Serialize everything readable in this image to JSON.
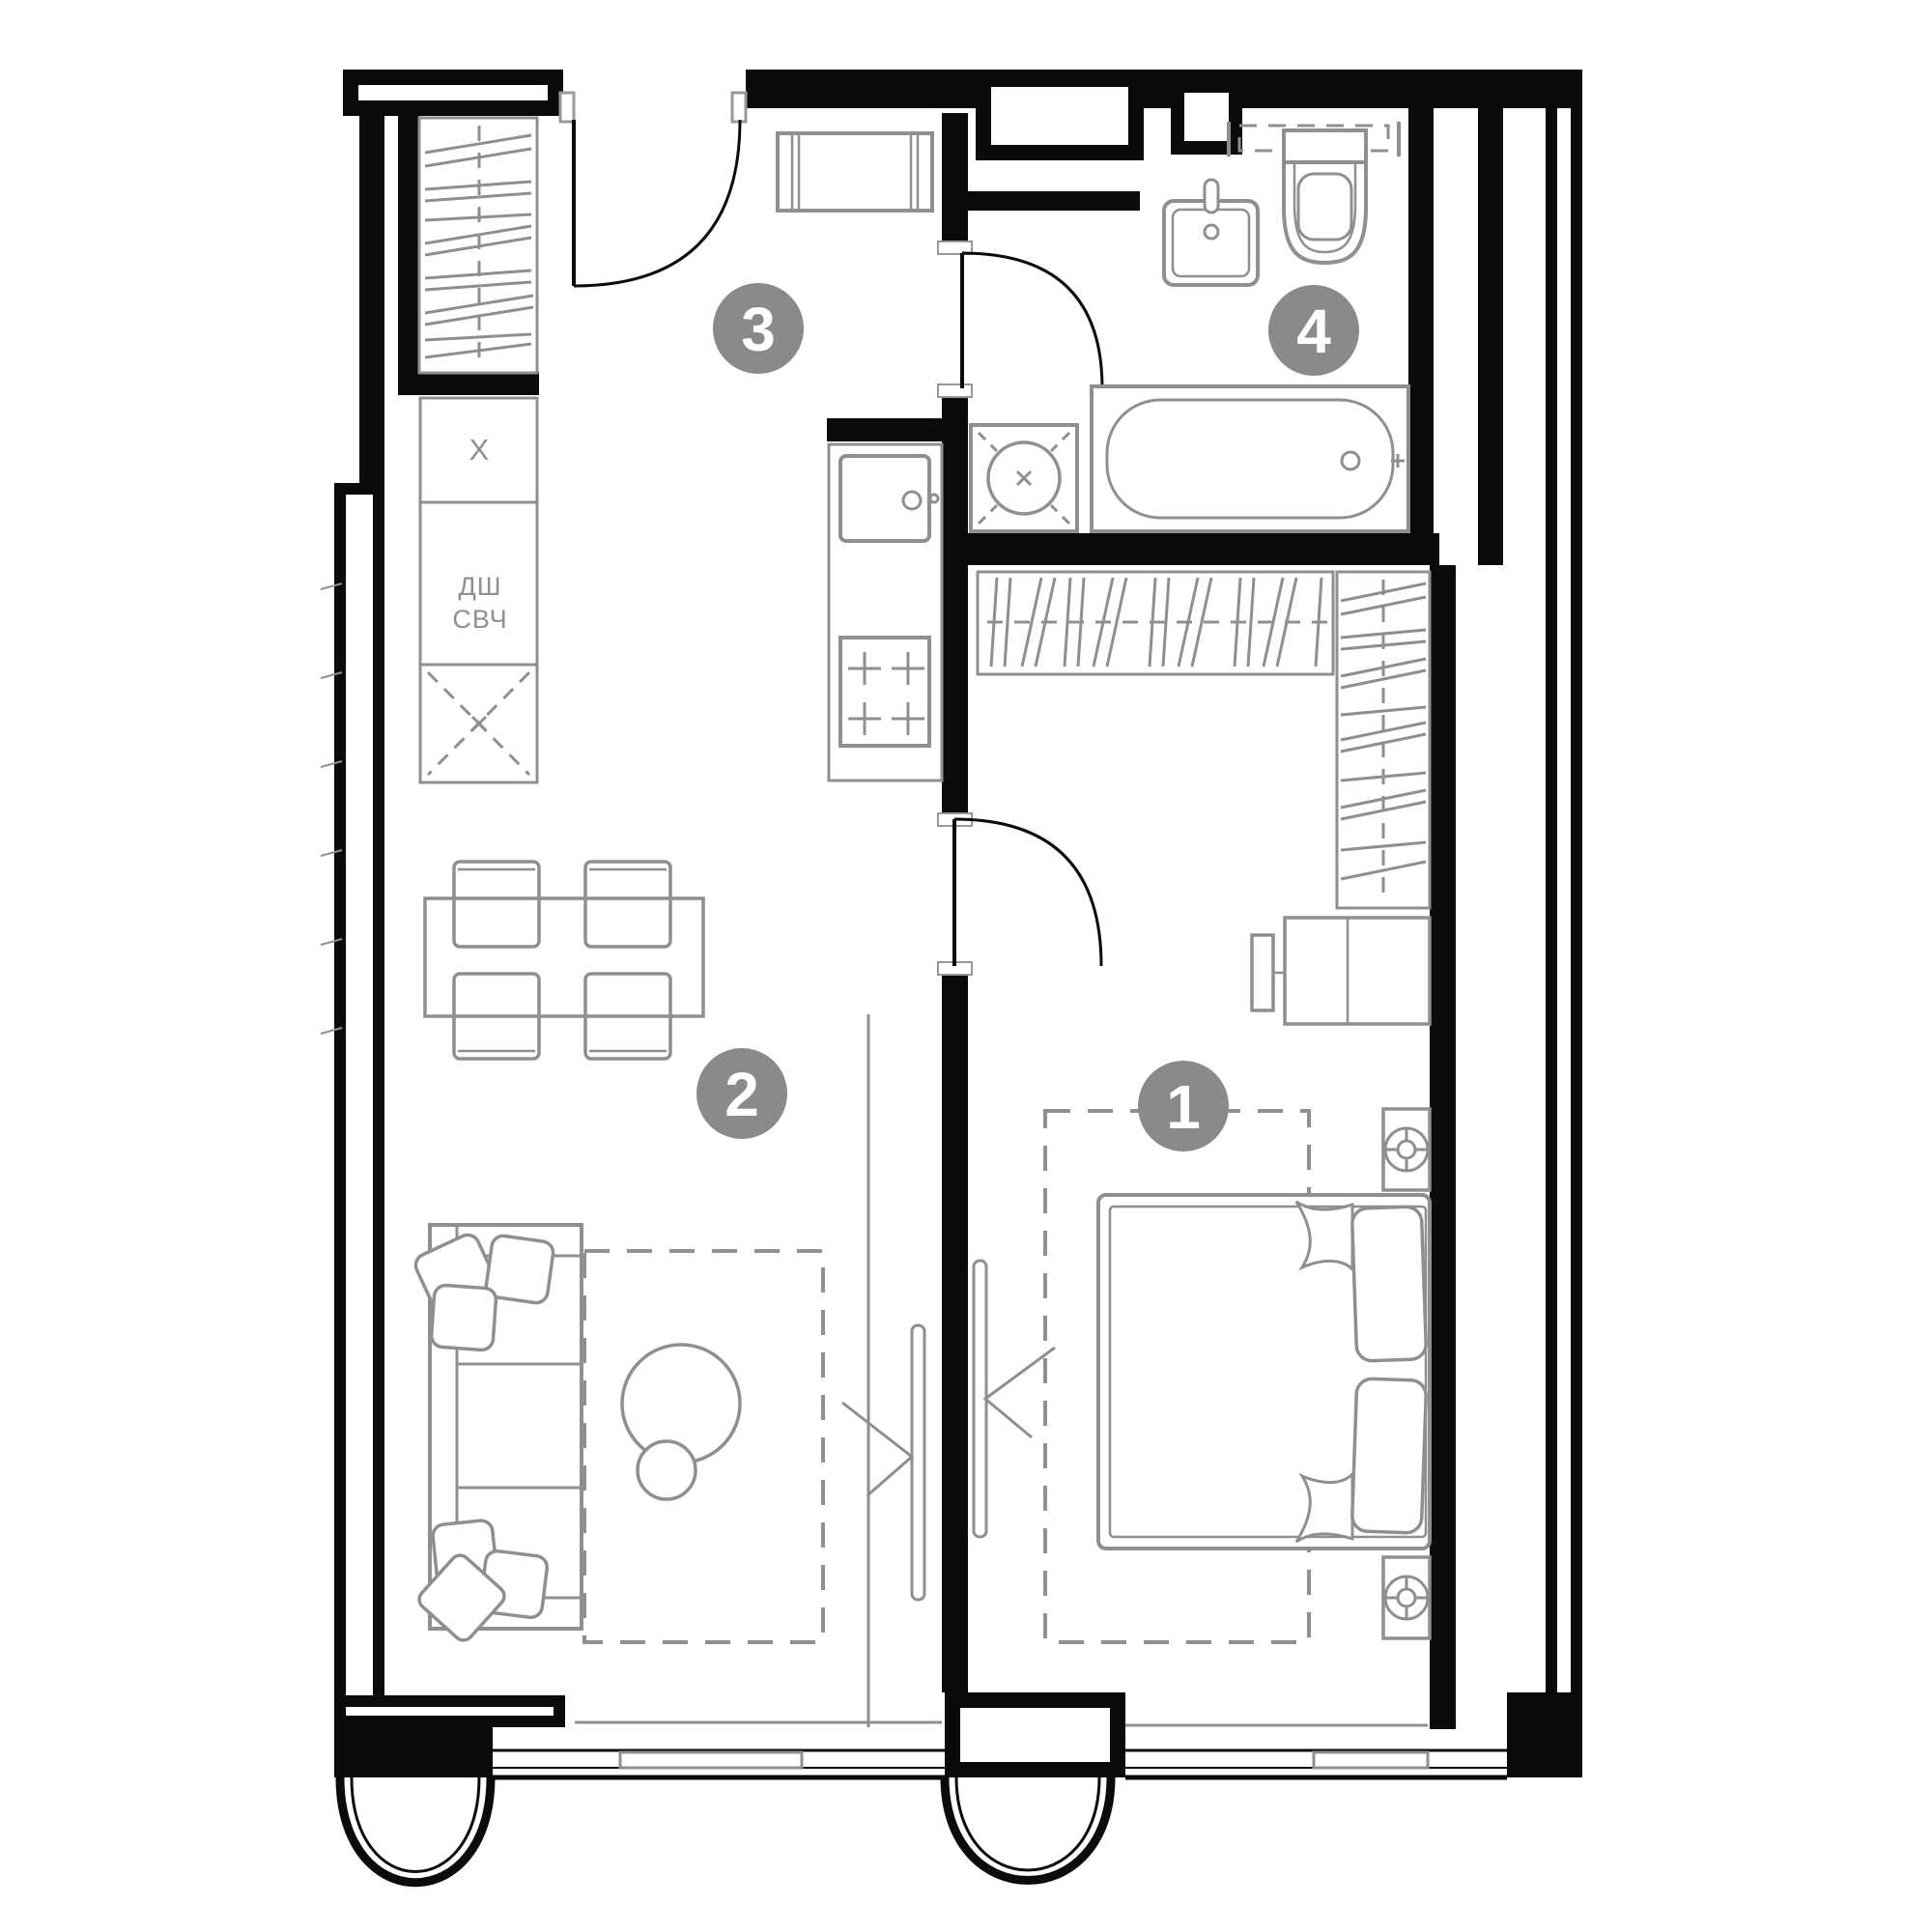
{
  "title": "Apartment floor plan",
  "rooms": [
    {
      "number": "1",
      "name": "bedroom"
    },
    {
      "number": "2",
      "name": "living-room"
    },
    {
      "number": "3",
      "name": "hallway-kitchen"
    },
    {
      "number": "4",
      "name": "bathroom"
    }
  ],
  "kitchen_labels": {
    "hood": "X",
    "dishwasher": "ДШ",
    "microwave": "СВЧ"
  },
  "colors": {
    "wall": "#0b0b0b",
    "furniture": "#8f8f8f",
    "badge": "#8a8a8a",
    "badge_text": "#ffffff",
    "background": "#ffffff"
  }
}
